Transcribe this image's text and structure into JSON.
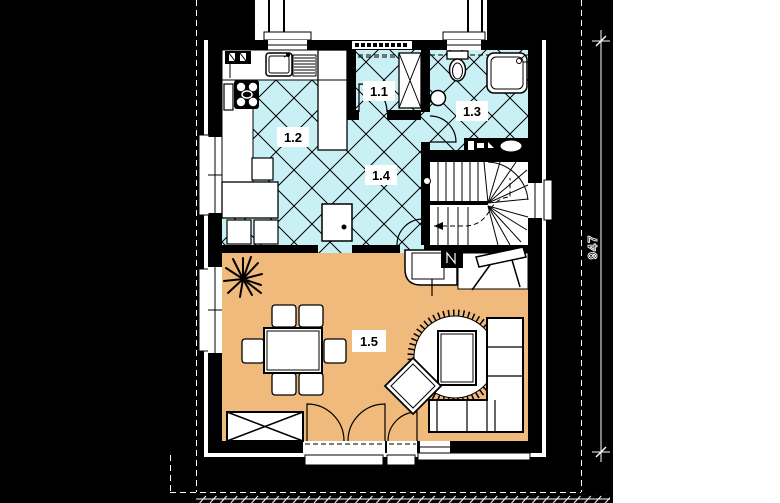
{
  "plan": {
    "rooms": [
      {
        "label": "1.1"
      },
      {
        "label": "1.2"
      },
      {
        "label": "1.3"
      },
      {
        "label": "1.4"
      },
      {
        "label": "1.5"
      }
    ],
    "dimensions": {
      "vertical": "947"
    },
    "colors": {
      "background": "#000000",
      "paper": "#ffffff",
      "wall": "#000000",
      "tile": "#c9f1f5",
      "floor": "#f0ba7d",
      "line": "#000000",
      "dimline": "#ffffff"
    }
  }
}
